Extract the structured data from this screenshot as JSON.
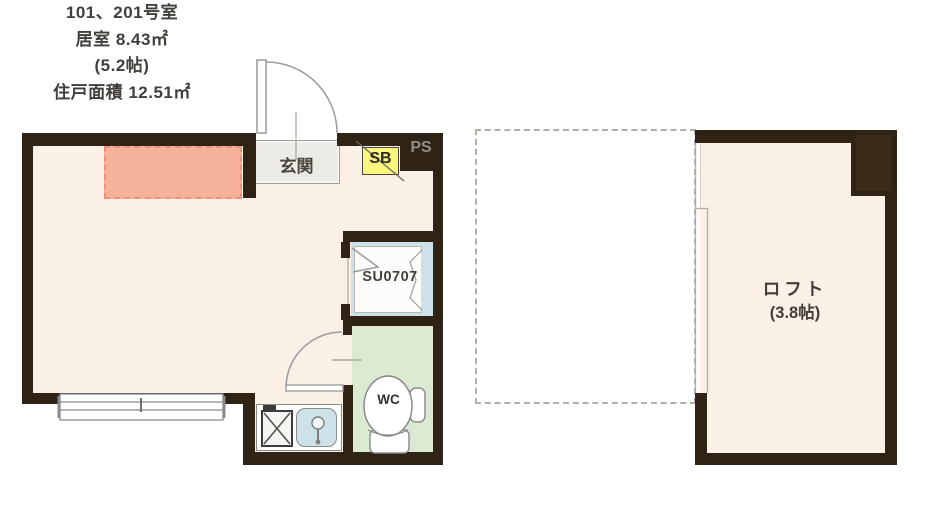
{
  "floorplan": {
    "unit_info": {
      "room_number": "101、201号室",
      "room_area": "居室 8.43㎡",
      "room_tatami": "(5.2帖)",
      "total_area": "住戸面積 12.51㎡"
    },
    "labels": {
      "entrance": "玄関",
      "shoe_box": "SB",
      "pipe_space": "PS",
      "unit_bath": "SU0707",
      "toilet": "WC"
    },
    "loft": {
      "name": "ロフト",
      "size": "(3.8帖)"
    },
    "colors": {
      "wall": "#2f2316",
      "floor": "#faf0e6",
      "loft_area_marker": "#f5b19a",
      "loft_marker_border": "#e8937a",
      "wc_floor": "#dcead3",
      "bath_blue": "#cde2e8",
      "shoe_box_yellow": "#f8f77c",
      "entrance_gray": "#eceae5",
      "pipe_space_text": "#918e88",
      "line_gray": "#9a9a9a"
    }
  }
}
